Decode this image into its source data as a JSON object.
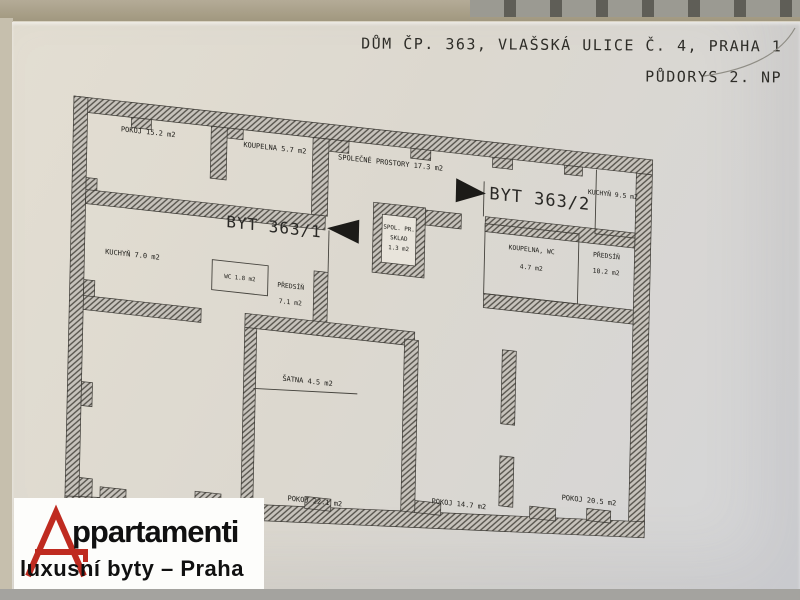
{
  "header": {
    "line1": "DŮM ČP. 363, VLAŠSKÁ ULICE Č. 4, PRAHA 1",
    "line2": "PŮDORYS 2. NP"
  },
  "plan": {
    "units": [
      {
        "label": "BYT 363/1"
      },
      {
        "label": "BYT 363/2"
      }
    ],
    "rooms": [
      {
        "lines": [
          "POKOJ 15.2 m2"
        ]
      },
      {
        "lines": [
          "KOUPELNA 5.7 m2"
        ]
      },
      {
        "lines": [
          "SPOLEČNÉ PROSTORY 17.3 m2"
        ]
      },
      {
        "lines": [
          "KUCHYŇ 7.0 m2"
        ]
      },
      {
        "lines": [
          "WC 1.8 m2"
        ]
      },
      {
        "lines": [
          "PŘEDSÍŇ",
          "7.1 m2"
        ]
      },
      {
        "lines": [
          "SPOL. PR.",
          "SKLAD",
          "1.3 m2"
        ]
      },
      {
        "lines": [
          "KOUPELNA, WC",
          "4.7 m2"
        ]
      },
      {
        "lines": [
          "PŘEDSÍŇ",
          "10.2 m2"
        ]
      },
      {
        "lines": [
          "KUCHYŇ 9.5 m2"
        ]
      },
      {
        "lines": [
          "ŠATNA 4.5 m2"
        ]
      },
      {
        "lines": [
          "POKOJ 22.1 m2"
        ]
      },
      {
        "lines": [
          "POKOJ 14.7 m2"
        ]
      },
      {
        "lines": [
          "POKOJ 20.5 m2"
        ]
      }
    ]
  },
  "logo": {
    "word_initial": "A",
    "word_rest": "ppartamenti",
    "tagline": "luxusní byty – Praha",
    "accent_color": "#bf2b20"
  },
  "colors": {
    "ink": "#2e2d28",
    "wall_fill": "#c7c3bc",
    "wall_hatch": "#55524b",
    "paper": "#dcd8cf"
  }
}
